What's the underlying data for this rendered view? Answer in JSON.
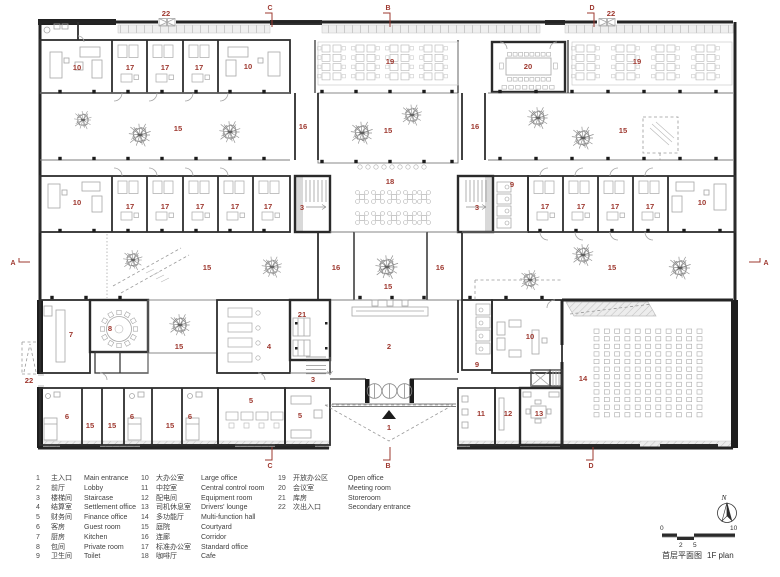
{
  "drawing": {
    "title_zh": "首层平面图",
    "title_en": "1F plan",
    "north_label": "N",
    "scale_ticks": [
      "0",
      "2",
      "5",
      "10"
    ],
    "accent_color": "#9e382f",
    "wall_color": "#242424"
  },
  "plan": {
    "room_labels": [
      {
        "t": "10",
        "x": 77,
        "y": 70
      },
      {
        "t": "17",
        "x": 130,
        "y": 70
      },
      {
        "t": "17",
        "x": 165,
        "y": 70
      },
      {
        "t": "17",
        "x": 199,
        "y": 70
      },
      {
        "t": "10",
        "x": 248,
        "y": 69
      },
      {
        "t": "19",
        "x": 390,
        "y": 64
      },
      {
        "t": "20",
        "x": 528,
        "y": 69
      },
      {
        "t": "19",
        "x": 637,
        "y": 64
      },
      {
        "t": "22",
        "x": 166,
        "y": 16
      },
      {
        "t": "22",
        "x": 611,
        "y": 16
      },
      {
        "t": "22",
        "x": 29,
        "y": 383
      },
      {
        "t": "15",
        "x": 178,
        "y": 131
      },
      {
        "t": "16",
        "x": 303,
        "y": 129
      },
      {
        "t": "15",
        "x": 388,
        "y": 133
      },
      {
        "t": "16",
        "x": 475,
        "y": 129
      },
      {
        "t": "15",
        "x": 623,
        "y": 133
      },
      {
        "t": "10",
        "x": 77,
        "y": 205
      },
      {
        "t": "17",
        "x": 130,
        "y": 209
      },
      {
        "t": "17",
        "x": 165,
        "y": 209
      },
      {
        "t": "17",
        "x": 200,
        "y": 209
      },
      {
        "t": "17",
        "x": 235,
        "y": 209
      },
      {
        "t": "17",
        "x": 268,
        "y": 209
      },
      {
        "t": "3",
        "x": 302,
        "y": 210
      },
      {
        "t": "18",
        "x": 390,
        "y": 184
      },
      {
        "t": "3",
        "x": 477,
        "y": 210
      },
      {
        "t": "9",
        "x": 512,
        "y": 187
      },
      {
        "t": "17",
        "x": 545,
        "y": 209
      },
      {
        "t": "17",
        "x": 581,
        "y": 209
      },
      {
        "t": "17",
        "x": 615,
        "y": 209
      },
      {
        "t": "17",
        "x": 650,
        "y": 209
      },
      {
        "t": "10",
        "x": 702,
        "y": 205
      },
      {
        "t": "15",
        "x": 207,
        "y": 270
      },
      {
        "t": "16",
        "x": 336,
        "y": 270
      },
      {
        "t": "15",
        "x": 388,
        "y": 289
      },
      {
        "t": "16",
        "x": 440,
        "y": 270
      },
      {
        "t": "15",
        "x": 612,
        "y": 270
      },
      {
        "t": "7",
        "x": 71,
        "y": 337
      },
      {
        "t": "8",
        "x": 110,
        "y": 331
      },
      {
        "t": "15",
        "x": 179,
        "y": 349
      },
      {
        "t": "4",
        "x": 269,
        "y": 349
      },
      {
        "t": "21",
        "x": 302,
        "y": 317
      },
      {
        "t": "2",
        "x": 389,
        "y": 349
      },
      {
        "t": "9",
        "x": 477,
        "y": 367
      },
      {
        "t": "10",
        "x": 530,
        "y": 339
      },
      {
        "t": "14",
        "x": 583,
        "y": 381
      },
      {
        "t": "3",
        "x": 313,
        "y": 382
      },
      {
        "t": "6",
        "x": 67,
        "y": 419
      },
      {
        "t": "15",
        "x": 90,
        "y": 428
      },
      {
        "t": "15",
        "x": 112,
        "y": 428
      },
      {
        "t": "6",
        "x": 132,
        "y": 419
      },
      {
        "t": "15",
        "x": 170,
        "y": 428
      },
      {
        "t": "6",
        "x": 190,
        "y": 419
      },
      {
        "t": "5",
        "x": 251,
        "y": 403
      },
      {
        "t": "5",
        "x": 300,
        "y": 418
      },
      {
        "t": "1",
        "x": 389,
        "y": 430
      },
      {
        "t": "11",
        "x": 481,
        "y": 416
      },
      {
        "t": "12",
        "x": 508,
        "y": 416
      },
      {
        "t": "13",
        "x": 539,
        "y": 416
      }
    ],
    "section_markers": [
      {
        "t": "C",
        "x": 270,
        "y": 10,
        "dir": "top"
      },
      {
        "t": "B",
        "x": 388,
        "y": 10,
        "dir": "top"
      },
      {
        "t": "D",
        "x": 592,
        "y": 10,
        "dir": "top"
      },
      {
        "t": "C",
        "x": 270,
        "y": 468,
        "dir": "bottom"
      },
      {
        "t": "B",
        "x": 388,
        "y": 468,
        "dir": "bottom"
      },
      {
        "t": "D",
        "x": 591,
        "y": 468,
        "dir": "bottom"
      },
      {
        "t": "A",
        "x": 13,
        "y": 265,
        "dir": "left"
      },
      {
        "t": "A",
        "x": 766,
        "y": 265,
        "dir": "right"
      }
    ]
  },
  "legend": {
    "columns": [
      [
        {
          "n": "1",
          "zh": "主入口",
          "en": "Main entrance"
        },
        {
          "n": "2",
          "zh": "前厅",
          "en": "Lobby"
        },
        {
          "n": "3",
          "zh": "楼梯间",
          "en": "Staircase"
        },
        {
          "n": "4",
          "zh": "结算室",
          "en": "Settlement office"
        },
        {
          "n": "5",
          "zh": "财务间",
          "en": "Finance office"
        },
        {
          "n": "6",
          "zh": "客房",
          "en": "Guest room"
        },
        {
          "n": "7",
          "zh": "厨房",
          "en": "Kitchen"
        },
        {
          "n": "8",
          "zh": "包间",
          "en": "Private room"
        },
        {
          "n": "9",
          "zh": "卫生间",
          "en": "Toilet"
        }
      ],
      [
        {
          "n": "10",
          "zh": "大办公室",
          "en": "Large office"
        },
        {
          "n": "11",
          "zh": "中控室",
          "en": "Central control room"
        },
        {
          "n": "12",
          "zh": "配电间",
          "en": "Equipment room"
        },
        {
          "n": "13",
          "zh": "司机休息室",
          "en": "Drivers' lounge"
        },
        {
          "n": "14",
          "zh": "多功能厅",
          "en": "Multi-function hall"
        },
        {
          "n": "15",
          "zh": "庭院",
          "en": "Courtyard"
        },
        {
          "n": "16",
          "zh": "连廊",
          "en": "Corridor"
        },
        {
          "n": "17",
          "zh": "标准办公室",
          "en": "Standard office"
        },
        {
          "n": "18",
          "zh": "咖啡厅",
          "en": "Cafe"
        }
      ],
      [
        {
          "n": "19",
          "zh": "开放办公区",
          "en": "Open office"
        },
        {
          "n": "20",
          "zh": "会议室",
          "en": "Meeting room"
        },
        {
          "n": "21",
          "zh": "库房",
          "en": "Storeroom"
        },
        {
          "n": "22",
          "zh": "次出入口",
          "en": "Secondary entrance"
        }
      ]
    ]
  }
}
